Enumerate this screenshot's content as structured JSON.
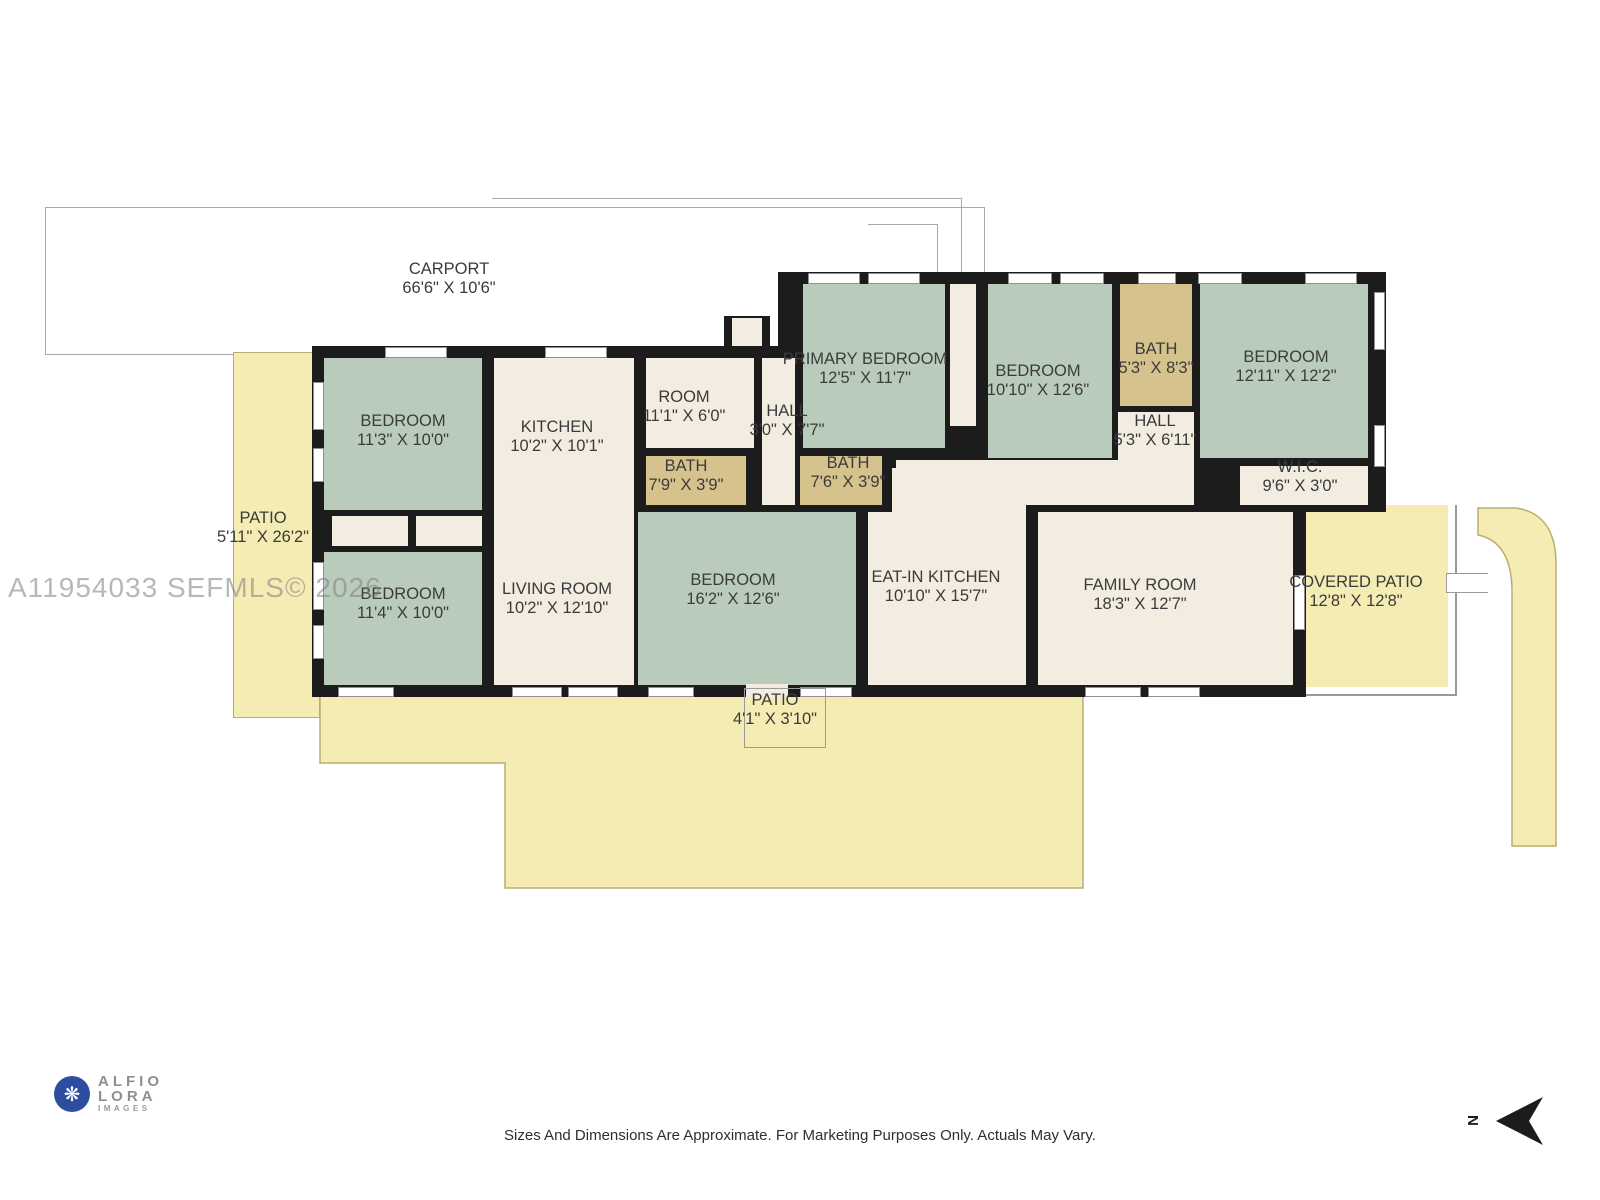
{
  "watermark": "A11954033  SEFMLS© 2026",
  "rooms": {
    "carport": {
      "name": "CARPORT",
      "dims": "66'6\" X 10'6\""
    },
    "patio_left": {
      "name": "PATIO",
      "dims": "5'11\" X 26'2\""
    },
    "bedroom_tl": {
      "name": "BEDROOM",
      "dims": "11'3\" X 10'0\""
    },
    "kitchen": {
      "name": "KITCHEN",
      "dims": "10'2\" X 10'1\""
    },
    "room": {
      "name": "ROOM",
      "dims": "11'1\" X 6'0\""
    },
    "hall_front": {
      "name": "HALL",
      "dims": "3'0\" X 7'7\""
    },
    "primary_bedroom": {
      "name": "PRIMARY BEDROOM",
      "dims": "12'5\" X 11'7\""
    },
    "bedroom_mid": {
      "name": "BEDROOM",
      "dims": "10'10\" X 12'6\""
    },
    "bath_right": {
      "name": "BATH",
      "dims": "5'3\" X 8'3\""
    },
    "bedroom_tr": {
      "name": "BEDROOM",
      "dims": "12'11\" X 12'2\""
    },
    "hall_right": {
      "name": "HALL",
      "dims": "5'3\" X 6'11\""
    },
    "wic": {
      "name": "W.I.C.",
      "dims": "9'6\" X 3'0\""
    },
    "bath_left": {
      "name": "BATH",
      "dims": "7'9\" X 3'9\""
    },
    "bath_mid": {
      "name": "BATH",
      "dims": "7'6\" X 3'9\""
    },
    "bedroom_bl": {
      "name": "BEDROOM",
      "dims": "11'4\" X 10'0\""
    },
    "living_room": {
      "name": "LIVING ROOM",
      "dims": "10'2\" X 12'10\""
    },
    "bedroom_bm": {
      "name": "BEDROOM",
      "dims": "16'2\" X 12'6\""
    },
    "eat_in_kitchen": {
      "name": "EAT-IN KITCHEN",
      "dims": "10'10\" X 15'7\""
    },
    "family_room": {
      "name": "FAMILY ROOM",
      "dims": "18'3\" X 12'7\""
    },
    "covered_patio": {
      "name": "COVERED PATIO",
      "dims": "12'8\" X 12'8\""
    },
    "patio_small": {
      "name": "PATIO",
      "dims": "4'1\" X 3'10\""
    }
  },
  "logo": {
    "line1": "ALFIO",
    "line2": "LORA",
    "line3": "IMAGES",
    "glyph": "❋"
  },
  "footer": {
    "disclaimer": "Sizes And Dimensions Are Approximate. For Marketing Purposes Only. Actuals May Vary."
  },
  "compass": {
    "label": "N"
  },
  "colors": {
    "bedroom_green": "#b9ccbc",
    "room_cream": "#f2ece1",
    "bath_tan": "#d6c28d",
    "patio_yellow": "#f5ecb4",
    "wall_black": "#1c1c1c",
    "outline_gray": "#a9a9a9",
    "watermark_gray": "#7d7d7d",
    "logo_blue": "#2d4da0"
  }
}
